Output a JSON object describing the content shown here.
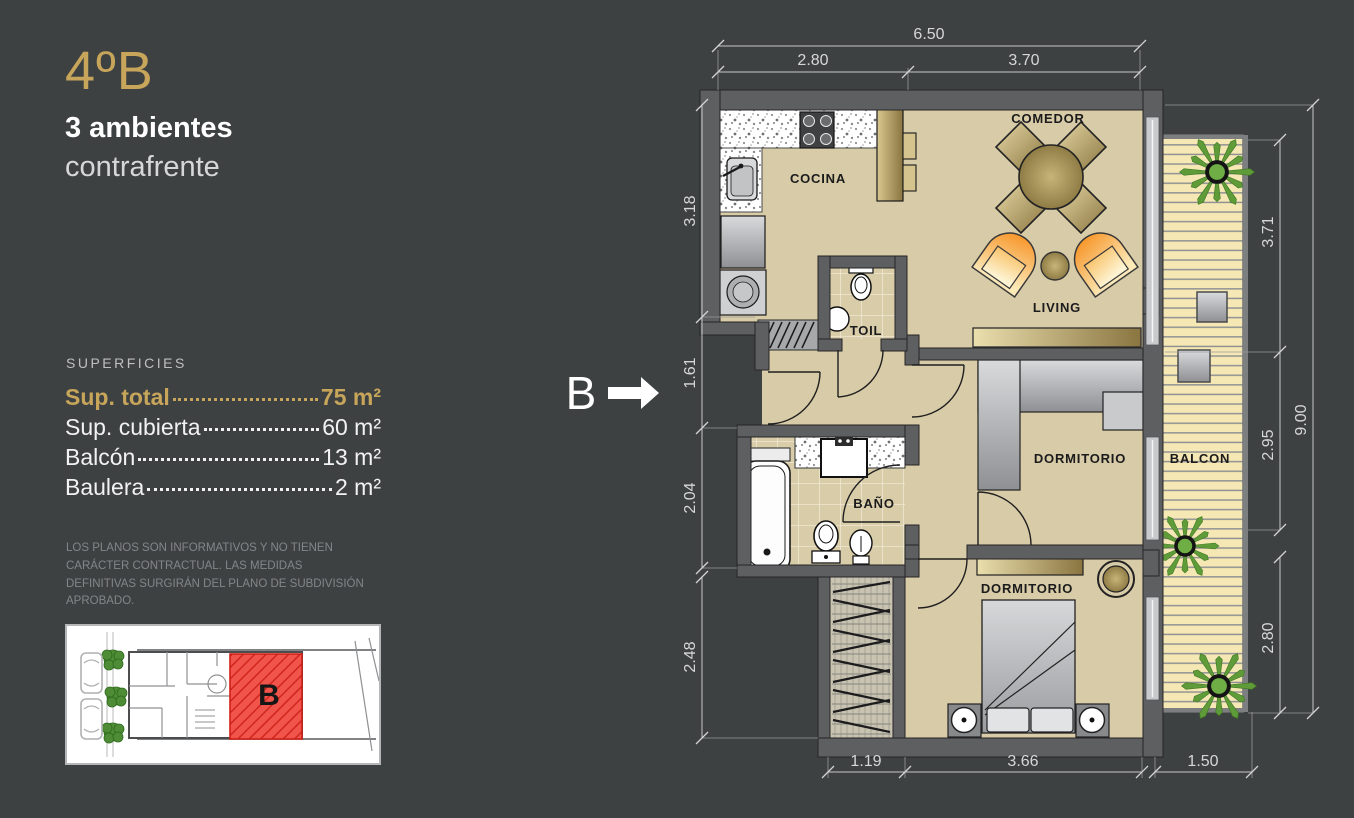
{
  "panel": {
    "unit_number": "4ºB",
    "subtitle_line1": "3 ambientes",
    "subtitle_line2": "contrafrente",
    "superficies_title": "SUPERFICIES",
    "areas": [
      {
        "label": "Sup. total",
        "value": "75 m²",
        "highlight": true
      },
      {
        "label": "Sup. cubierta",
        "value": "60 m²",
        "highlight": false
      },
      {
        "label": "Balcón",
        "value": "13 m²",
        "highlight": false
      },
      {
        "label": "Baulera",
        "value": "2 m²",
        "highlight": false
      }
    ],
    "disclaimer": "LOS PLANOS SON INFORMATIVOS Y NO TIENEN CARÁCTER CONTRACTUAL. LAS MEDIDAS DEFINITIVAS SURGIRÁN DEL PLANO DE SUBDIVISIÓN APROBADO."
  },
  "keyplan": {
    "unit_letter": "B"
  },
  "plan": {
    "section_marker": "B",
    "rooms": {
      "cocina": "COCINA",
      "comedor": "COMEDOR",
      "living": "LIVING",
      "toil": "TOIL",
      "bano": "BAÑO",
      "dormitorio1": "DORMITORIO",
      "dormitorio2": "DORMITORIO",
      "balcon": "BALCON"
    },
    "dims": {
      "top_total": "6.50",
      "top_left": "2.80",
      "top_right": "3.70",
      "left_1": "3.18",
      "left_2": "1.61",
      "left_3": "2.04",
      "left_4": "2.48",
      "right_1": "3.71",
      "right_2": "2.95",
      "right_3": "2.80",
      "right_total": "9.00",
      "bottom_1": "1.19",
      "bottom_2": "3.66",
      "bottom_3": "1.50"
    }
  },
  "colors": {
    "background": "#3e4142",
    "accent_gold": "#c7a55a",
    "floor_beige": "#d8cba7",
    "deck_yellow": "#f5e8b4",
    "wall_gray": "#5e5f61",
    "keyplan_red": "#f0483e",
    "chair_orange": "#f78f1e"
  }
}
